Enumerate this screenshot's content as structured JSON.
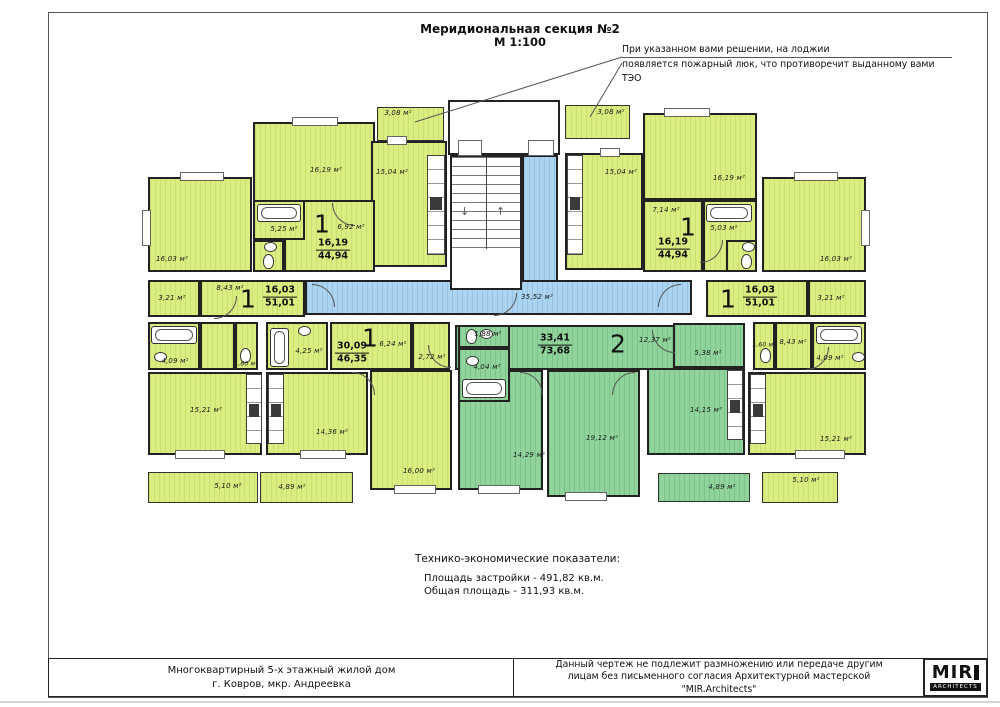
{
  "title": {
    "line1": "Меридиональная секция №2",
    "line2": "М 1:100"
  },
  "annotation": {
    "line1": "При указанном вами решении, на лоджии",
    "line2": "появляется пожарный люк, что противоречит выданному вами ТЭО"
  },
  "corridor_area": "35,52 м²",
  "apartments": {
    "top_left": {
      "number": "1",
      "living_area": "16,19",
      "total_area": "44,94"
    },
    "mid_left": {
      "number": "1",
      "living_area": "16,03",
      "total_area": "51,01"
    },
    "low_left": {
      "number": "1",
      "living_area": "30,09",
      "total_area": "46,35"
    },
    "center": {
      "number": "2",
      "living_area": "33,41",
      "total_area": "73,68"
    },
    "top_right": {
      "number": "1",
      "living_area": "16,19",
      "total_area": "44,94"
    },
    "mid_right": {
      "number": "1",
      "living_area": "16,03",
      "total_area": "51,01"
    }
  },
  "rooms": {
    "tl_bedroom": "16,03 м²",
    "tl_living": "16,19 м²",
    "tl_balcony": "3,08 м²",
    "tl_kitchen": "15,04 м²",
    "tl_bath": "5,25 м²",
    "tl_hall": "6,92 м²",
    "ml_store": "3,21 м²",
    "ml_hall": "8,43 м²",
    "ml_bath": "4,09 м²",
    "ml_wc": "1,60 м²",
    "ml_living": "15,21 м²",
    "ml_balcony": "5,10 м²",
    "ll_bath": "4,25 м²",
    "ll_hall": "6,24 м²",
    "ll_store": "2,72 м²",
    "ll_kitchen": "14,36 м²",
    "ll_room": "16,00 м²",
    "ll_balcony": "4,89 м²",
    "c_wc": "1,88 м²",
    "c_hall": "12,37 м²",
    "c_room_small": "5,38 м²",
    "c_bath": "4,04 м²",
    "c_kitchen": "14,15 м²",
    "c_bedroom1": "14,29 м²",
    "c_bedroom2": "19,12 м²",
    "c_balcony": "4,89 м²",
    "tr_balcony": "3,08 м²",
    "tr_kitchen": "15,04 м²",
    "tr_living": "16,19 м²",
    "tr_hall": "7,14 м²",
    "tr_bath": "5,03 м²",
    "tr_bedroom": "16,03 м²",
    "mr_store": "3,21 м²",
    "mr_wc": "1,60 м²",
    "mr_hall": "8,43 м²",
    "mr_bath": "4,09 м²",
    "mr_living": "15,21 м²",
    "mr_balcony": "5,10 м²"
  },
  "indicators": {
    "heading": "Технико-экономические показатели:",
    "rows": [
      "Площадь застройки - 491,82 кв.м.",
      "Общая площадь - 311,93 кв.м."
    ]
  },
  "footer": {
    "project": {
      "line1": "Многоквартирный 5-х этажный жилой дом",
      "line2": "г. Ковров, мкр. Андреевка"
    },
    "copyright": {
      "line1": "Данный чертеж не подлежит размножению или передаче другим",
      "line2": "лицам без письменного согласия Архитектурной мастерской",
      "line3": "\"MIR.Architects\""
    },
    "logo": {
      "name": "MIR",
      "subtitle": "ARCHITECTS"
    }
  },
  "colors": {
    "apartment_type1": "#d9ed80",
    "apartment_type2": "#90d49b",
    "corridor": "#abd4f1",
    "walls": "#222222"
  }
}
